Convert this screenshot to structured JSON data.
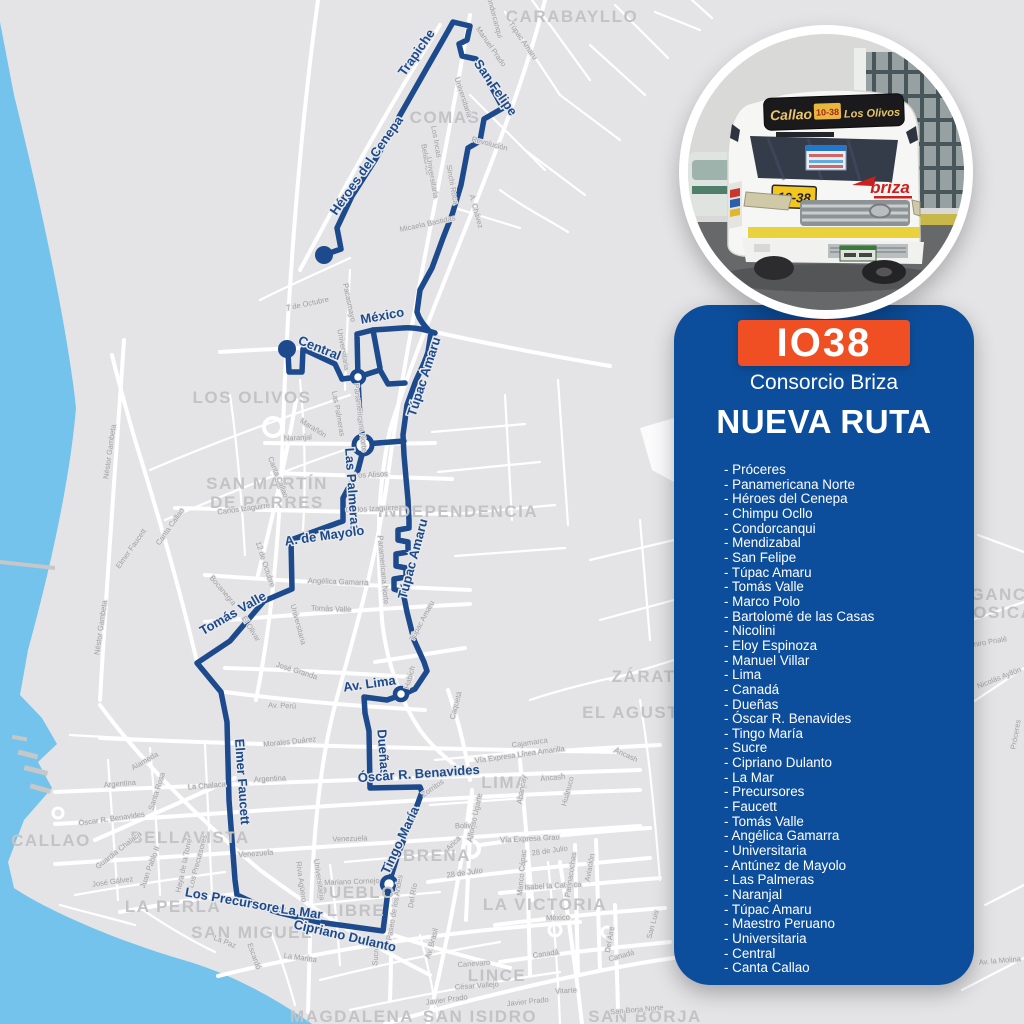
{
  "colors": {
    "panel": "#0d4e9c",
    "badge": "#f04e23",
    "route": "#1c4a8d",
    "water": "#74c3ec",
    "map_bg": "#e4e4e6",
    "road": "#ffffff",
    "district": "#c3c3c6",
    "street_label": "#a0a0a3"
  },
  "panel": {
    "code": "IO38",
    "operator": "Consorcio Briza",
    "title": "NUEVA RUTA",
    "list_prefix": "- ",
    "streets": [
      "Próceres",
      "Panamericana Norte",
      "Héroes del Cenepa",
      "Chimpu Ocllo",
      "Condorcanqui",
      "Mendizabal",
      "San Felipe",
      "Túpac Amaru",
      "Tomás Valle",
      "Marco Polo",
      "Bartolomé de las Casas",
      "Nicolini",
      "Eloy Espinoza",
      "Manuel Villar",
      "Lima",
      "Canadá",
      "Dueñas",
      "Óscar R. Benavides",
      "Tingo María",
      "Sucre",
      "Cipriano Dulanto",
      "La Mar",
      "Precursores",
      "Faucett",
      "Tomás Valle",
      "Angélica Gamarra",
      "Universitaria",
      "Antúnez de Mayolo",
      "Las Palmeras",
      "Naranjal",
      "Túpac Amaru",
      "Maestro Peruano",
      "Universitaria",
      "Central",
      "Canta Callao"
    ]
  },
  "bus_photo": {
    "sign_left": "Callao",
    "sign_code": "10-38",
    "sign_right": "Los Olivos",
    "placard": "10-38",
    "brand": "briza"
  },
  "map": {
    "districts": [
      {
        "text": "CARABAYLLO",
        "x": 572,
        "y": 22
      },
      {
        "text": "COMAS",
        "x": 445,
        "y": 123
      },
      {
        "text": "LOS OLIVOS",
        "x": 252,
        "y": 403
      },
      {
        "text": "SAN MARTÍN",
        "x": 267,
        "y": 489
      },
      {
        "text": "DE PORRES",
        "x": 267,
        "y": 508
      },
      {
        "text": "INDEPENDENCIA",
        "x": 458,
        "y": 517
      },
      {
        "text": "LURIGANCHO",
        "x": 990,
        "y": 600,
        "anchor": "start"
      },
      {
        "text": "CHOSICA",
        "x": 990,
        "y": 618,
        "anchor": "start"
      },
      {
        "text": "ZÁRATE",
        "x": 650,
        "y": 682,
        "anchor": "start"
      },
      {
        "text": "EL AGUSTINO",
        "x": 648,
        "y": 718,
        "anchor": "start"
      },
      {
        "text": "CALLAO",
        "x": 51,
        "y": 846
      },
      {
        "text": "BELLAVISTA",
        "x": 190,
        "y": 843
      },
      {
        "text": "LA PERLA",
        "x": 173,
        "y": 912
      },
      {
        "text": "SAN MIGUEL",
        "x": 252,
        "y": 938
      },
      {
        "text": "PUEBLO",
        "x": 356,
        "y": 898
      },
      {
        "text": "LIBRE",
        "x": 356,
        "y": 916
      },
      {
        "text": "BREÑA",
        "x": 437,
        "y": 861
      },
      {
        "text": "LIMA",
        "x": 505,
        "y": 788
      },
      {
        "text": "LA VICTORIA",
        "x": 545,
        "y": 910
      },
      {
        "text": "LINCE",
        "x": 497,
        "y": 981
      },
      {
        "text": "MAGDALENA",
        "x": 352,
        "y": 1022
      },
      {
        "text": "SAN ISIDRO",
        "x": 480,
        "y": 1022
      },
      {
        "text": "SAN BORJA",
        "x": 645,
        "y": 1022,
        "anchor": "start"
      }
    ],
    "route_labels": [
      {
        "text": "Trapiche",
        "x": 420,
        "y": 55,
        "r": -55
      },
      {
        "text": "San Felipe",
        "x": 492,
        "y": 90,
        "r": 55
      },
      {
        "text": "Héroes del Cenepa",
        "x": 370,
        "y": 168,
        "r": -55
      },
      {
        "text": "México",
        "x": 383,
        "y": 320,
        "r": -10
      },
      {
        "text": "Central",
        "x": 318,
        "y": 352,
        "r": 22
      },
      {
        "text": "Túpac Amaru",
        "x": 428,
        "y": 378,
        "r": -72
      },
      {
        "text": "Las Palmeras",
        "x": 348,
        "y": 490,
        "r": 86
      },
      {
        "text": "Túpac Amaru",
        "x": 417,
        "y": 560,
        "r": -75
      },
      {
        "text": "A. de Mayolo",
        "x": 325,
        "y": 540,
        "r": -8
      },
      {
        "text": "Tomás Valle",
        "x": 235,
        "y": 617,
        "r": -30
      },
      {
        "text": "Av. Lima",
        "x": 370,
        "y": 688,
        "r": -8
      },
      {
        "text": "Elmer Faucett",
        "x": 238,
        "y": 782,
        "r": 86
      },
      {
        "text": "Dueñas",
        "x": 379,
        "y": 753,
        "r": 86
      },
      {
        "text": "Óscar R. Benavides",
        "x": 419,
        "y": 778,
        "r": -4
      },
      {
        "text": "Tingo María",
        "x": 404,
        "y": 842,
        "r": -65
      },
      {
        "text": "Los Precursores",
        "x": 235,
        "y": 905,
        "r": 10
      },
      {
        "text": "La Mar",
        "x": 301,
        "y": 916,
        "r": 8
      },
      {
        "text": "Cipriano Dulanto",
        "x": 344,
        "y": 940,
        "r": 13
      }
    ],
    "street_labels": [
      {
        "text": "Condorcanqui",
        "x": 492,
        "y": 16,
        "r": 75
      },
      {
        "text": "Manuel Prado",
        "x": 489,
        "y": 48,
        "r": 55
      },
      {
        "text": "Túpac Amaru",
        "x": 521,
        "y": 42,
        "r": 55
      },
      {
        "text": "Universitaria",
        "x": 461,
        "y": 98,
        "r": 72
      },
      {
        "text": "Revolución",
        "x": 489,
        "y": 146,
        "r": 15
      },
      {
        "text": "Los Incas",
        "x": 434,
        "y": 142,
        "r": 80
      },
      {
        "text": "Belaúnde",
        "x": 424,
        "y": 160,
        "r": 80
      },
      {
        "text": "Universitaria",
        "x": 430,
        "y": 178,
        "r": 80
      },
      {
        "text": "Sinchi Roca",
        "x": 450,
        "y": 185,
        "r": 80
      },
      {
        "text": "A. Chávez",
        "x": 474,
        "y": 212,
        "r": 75
      },
      {
        "text": "Micaela Bastidas",
        "x": 428,
        "y": 226,
        "r": -12
      },
      {
        "text": "7 de Octubre",
        "x": 308,
        "y": 306,
        "r": -12
      },
      {
        "text": "Pacasmayo",
        "x": 347,
        "y": 303,
        "r": 78
      },
      {
        "text": "Universitaria",
        "x": 341,
        "y": 350,
        "r": 80
      },
      {
        "text": "Las Palmeras",
        "x": 336,
        "y": 414,
        "r": 80
      },
      {
        "text": "Panamericana Norte",
        "x": 358,
        "y": 418,
        "r": 83
      },
      {
        "text": "Naranjal",
        "x": 298,
        "y": 440,
        "r": -3
      },
      {
        "text": "Los Alisos",
        "x": 371,
        "y": 477,
        "r": -3
      },
      {
        "text": "Carlos Izaguirre",
        "x": 372,
        "y": 511,
        "r": -3
      },
      {
        "text": "Carlos Izaguirre",
        "x": 244,
        "y": 511,
        "r": -8
      },
      {
        "text": "Canta Callao",
        "x": 276,
        "y": 478,
        "r": 68
      },
      {
        "text": "Marañón",
        "x": 312,
        "y": 430,
        "r": 32
      },
      {
        "text": "Canta Callao",
        "x": 172,
        "y": 528,
        "r": -55
      },
      {
        "text": "Néstor Gambeta",
        "x": 112,
        "y": 452,
        "r": -82
      },
      {
        "text": "Néstor Gambeta",
        "x": 103,
        "y": 628,
        "r": -82
      },
      {
        "text": "Elmer Faucett",
        "x": 133,
        "y": 550,
        "r": -55
      },
      {
        "text": "12 de Octubre",
        "x": 263,
        "y": 565,
        "r": 72
      },
      {
        "text": "Bocanegra",
        "x": 221,
        "y": 592,
        "r": 50
      },
      {
        "text": "El Olivar",
        "x": 249,
        "y": 630,
        "r": 58
      },
      {
        "text": "Universitaria",
        "x": 296,
        "y": 625,
        "r": 75
      },
      {
        "text": "Angélica Gamarra",
        "x": 338,
        "y": 584,
        "r": 2
      },
      {
        "text": "Tomás Valle",
        "x": 331,
        "y": 611,
        "r": 2
      },
      {
        "text": "Panamericana Norte",
        "x": 381,
        "y": 570,
        "r": 85
      },
      {
        "text": "Túpac Amaru",
        "x": 424,
        "y": 622,
        "r": -62
      },
      {
        "text": "Habich",
        "x": 412,
        "y": 678,
        "r": -75
      },
      {
        "text": "José Granda",
        "x": 296,
        "y": 673,
        "r": 18
      },
      {
        "text": "Av. Perú",
        "x": 282,
        "y": 708,
        "r": 2
      },
      {
        "text": "Caquetá",
        "x": 458,
        "y": 706,
        "r": -75
      },
      {
        "text": "Morales Duárez",
        "x": 290,
        "y": 744,
        "r": -6
      },
      {
        "text": "Argentina",
        "x": 270,
        "y": 781,
        "r": -3
      },
      {
        "text": "Argentina",
        "x": 120,
        "y": 786,
        "r": -5
      },
      {
        "text": "La Chalaca",
        "x": 207,
        "y": 788,
        "r": -5
      },
      {
        "text": "Venezuela",
        "x": 256,
        "y": 856,
        "r": -4
      },
      {
        "text": "Venezuela",
        "x": 350,
        "y": 841,
        "r": -2
      },
      {
        "text": "Óscar R. Benavides",
        "x": 112,
        "y": 821,
        "r": -8
      },
      {
        "text": "Santa Rosa",
        "x": 159,
        "y": 792,
        "r": -72
      },
      {
        "text": "Alameda",
        "x": 146,
        "y": 763,
        "r": -30
      },
      {
        "text": "Guardia Chalaca",
        "x": 120,
        "y": 852,
        "r": -38
      },
      {
        "text": "José Gálvez",
        "x": 113,
        "y": 884,
        "r": -8
      },
      {
        "text": "Juan Pablo II",
        "x": 152,
        "y": 868,
        "r": -70
      },
      {
        "text": "Haya de la Torre",
        "x": 186,
        "y": 866,
        "r": -78
      },
      {
        "text": "Los Precursores",
        "x": 200,
        "y": 862,
        "r": -75
      },
      {
        "text": "La Paz",
        "x": 224,
        "y": 944,
        "r": 22
      },
      {
        "text": "Escardó",
        "x": 252,
        "y": 957,
        "r": 70
      },
      {
        "text": "La Marina",
        "x": 300,
        "y": 960,
        "r": 8
      },
      {
        "text": "Riva Agüero",
        "x": 299,
        "y": 882,
        "r": 82
      },
      {
        "text": "Universitaria",
        "x": 317,
        "y": 880,
        "r": 82
      },
      {
        "text": "Mariano Cornejo",
        "x": 352,
        "y": 884,
        "r": -2
      },
      {
        "text": "Paseo de los Andes",
        "x": 397,
        "y": 908,
        "r": -80
      },
      {
        "text": "Del Río",
        "x": 415,
        "y": 896,
        "r": -80
      },
      {
        "text": "Av. Brasil",
        "x": 434,
        "y": 944,
        "r": -75
      },
      {
        "text": "Sucre",
        "x": 378,
        "y": 956,
        "r": -85
      },
      {
        "text": "Zorritos",
        "x": 434,
        "y": 790,
        "r": -35
      },
      {
        "text": "Bolivia",
        "x": 466,
        "y": 828,
        "r": -2
      },
      {
        "text": "Arica",
        "x": 455,
        "y": 845,
        "r": -45
      },
      {
        "text": "Alfonso Ugarte",
        "x": 477,
        "y": 818,
        "r": -78
      },
      {
        "text": "28 de Julio",
        "x": 465,
        "y": 875,
        "r": -8
      },
      {
        "text": "Cajamarca",
        "x": 530,
        "y": 745,
        "r": -8
      },
      {
        "text": "Vía Expresa Línea Amarilla",
        "x": 520,
        "y": 757,
        "r": -8
      },
      {
        "text": "Ancash",
        "x": 625,
        "y": 757,
        "r": 25
      },
      {
        "text": "Ancash",
        "x": 553,
        "y": 780,
        "r": -5
      },
      {
        "text": "Abancay",
        "x": 524,
        "y": 790,
        "r": -80
      },
      {
        "text": "Huánuco",
        "x": 570,
        "y": 792,
        "r": -75
      },
      {
        "text": "Vía Expresa Grau",
        "x": 530,
        "y": 841,
        "r": -3
      },
      {
        "text": "28 de Julio",
        "x": 550,
        "y": 853,
        "r": -8
      },
      {
        "text": "Isabel la Católica",
        "x": 553,
        "y": 888,
        "r": -3
      },
      {
        "text": "México",
        "x": 558,
        "y": 920,
        "r": -2
      },
      {
        "text": "Parinacochas",
        "x": 573,
        "y": 875,
        "r": -82
      },
      {
        "text": "Manco Cápac",
        "x": 524,
        "y": 873,
        "r": -85
      },
      {
        "text": "Aviación",
        "x": 592,
        "y": 868,
        "r": -80
      },
      {
        "text": "Canadá",
        "x": 546,
        "y": 956,
        "r": -8
      },
      {
        "text": "Canadá",
        "x": 622,
        "y": 958,
        "r": -15
      },
      {
        "text": "Del Aire",
        "x": 612,
        "y": 940,
        "r": -80
      },
      {
        "text": "San Luis",
        "x": 655,
        "y": 925,
        "r": -75
      },
      {
        "text": "Vitarte",
        "x": 566,
        "y": 993,
        "r": -3
      },
      {
        "text": "Canevaro",
        "x": 474,
        "y": 966,
        "r": -4
      },
      {
        "text": "César Vallejo",
        "x": 477,
        "y": 988,
        "r": -4
      },
      {
        "text": "Javier Prado",
        "x": 528,
        "y": 1004,
        "r": -6
      },
      {
        "text": "Javier Prado",
        "x": 447,
        "y": 1002,
        "r": -8
      },
      {
        "text": "San Borja Norte",
        "x": 637,
        "y": 1012,
        "r": -5
      },
      {
        "text": "Ramiro Prialé",
        "x": 985,
        "y": 645,
        "r": -10
      },
      {
        "text": "Nicolás Ayllón",
        "x": 1000,
        "y": 680,
        "r": -22
      },
      {
        "text": "Av. la Molina",
        "x": 1000,
        "y": 963,
        "r": -5
      },
      {
        "text": "Próceres",
        "x": 1018,
        "y": 735,
        "r": -80
      }
    ]
  }
}
